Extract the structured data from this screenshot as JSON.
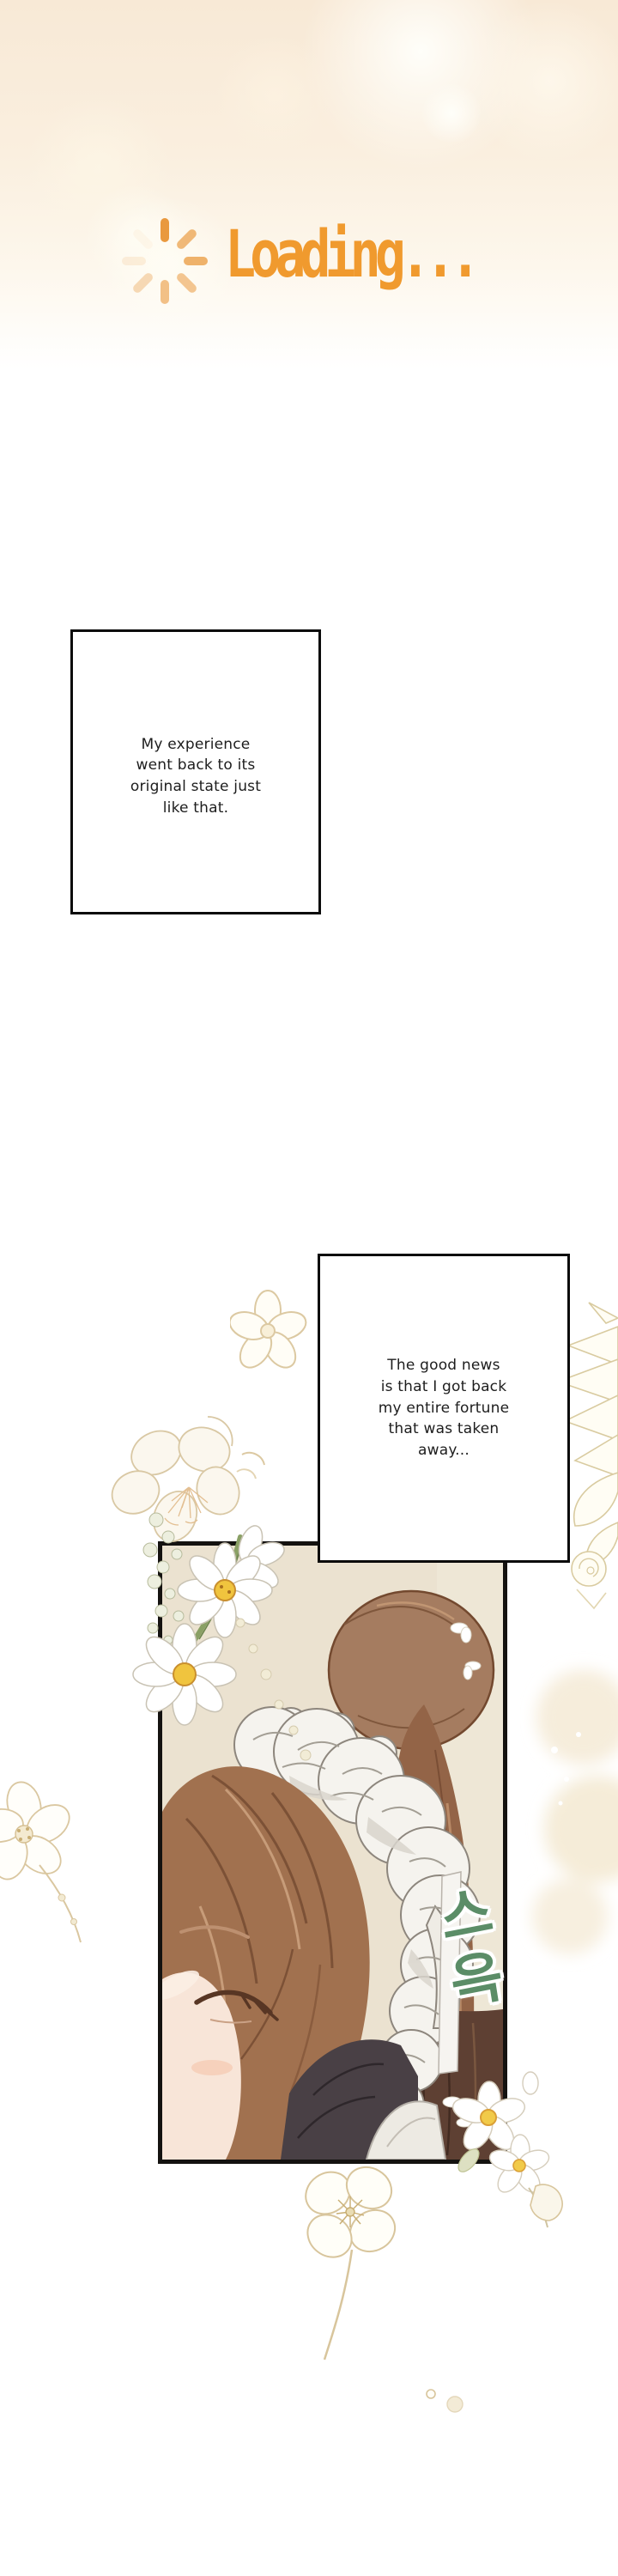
{
  "loading": {
    "label": "Loading...",
    "text_color": "#f09a2e",
    "spinner_icon": "spinner-icon",
    "spinner_color": "#e9993e"
  },
  "speech": {
    "bubble1": "My experience\nwent back to its\noriginal state just\nlike that.",
    "bubble2": "The good news\nis that I got back\nmy entire fortune\nthat was taken\naway..."
  },
  "sfx": {
    "label": "스윽",
    "color": "#5b8d67"
  },
  "colors": {
    "top_gradient_peach": "#f8e9d6",
    "page_background": "#ffffff",
    "caption_border": "#0b0b0b",
    "panel_border": "#141210",
    "panel_wall_beige": "#ebe2d0",
    "hair_brown": "#a1714f",
    "flower_line_tan": "#d8c59c",
    "daisy_center_yellow": "#f0c43e",
    "stem_green": "#8aa065"
  }
}
